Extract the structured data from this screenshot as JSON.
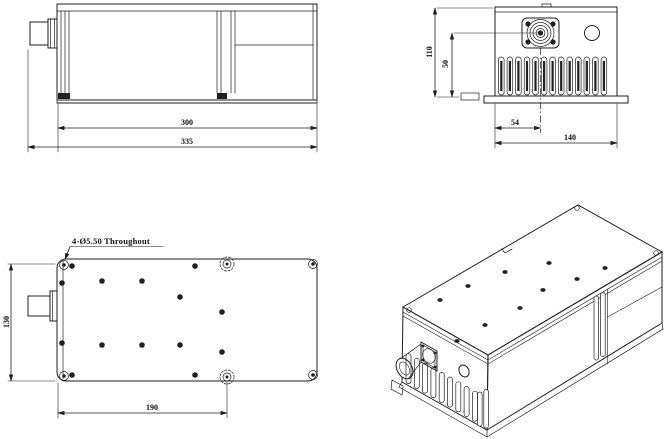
{
  "colors": {
    "background": "#ffffff",
    "line": "#1f1f1f"
  },
  "views": {
    "side": {
      "dim_body_length": "300",
      "dim_total_length": "335"
    },
    "front": {
      "dim_total_height": "110",
      "dim_aperture_center_height": "50",
      "dim_aperture_center_offset": "54",
      "dim_total_width": "140"
    },
    "top": {
      "dim_total_depth": "130",
      "dim_mount_hole_spacing": "190",
      "mount_hole_note": "4-Ø5.50 Throughout"
    }
  }
}
